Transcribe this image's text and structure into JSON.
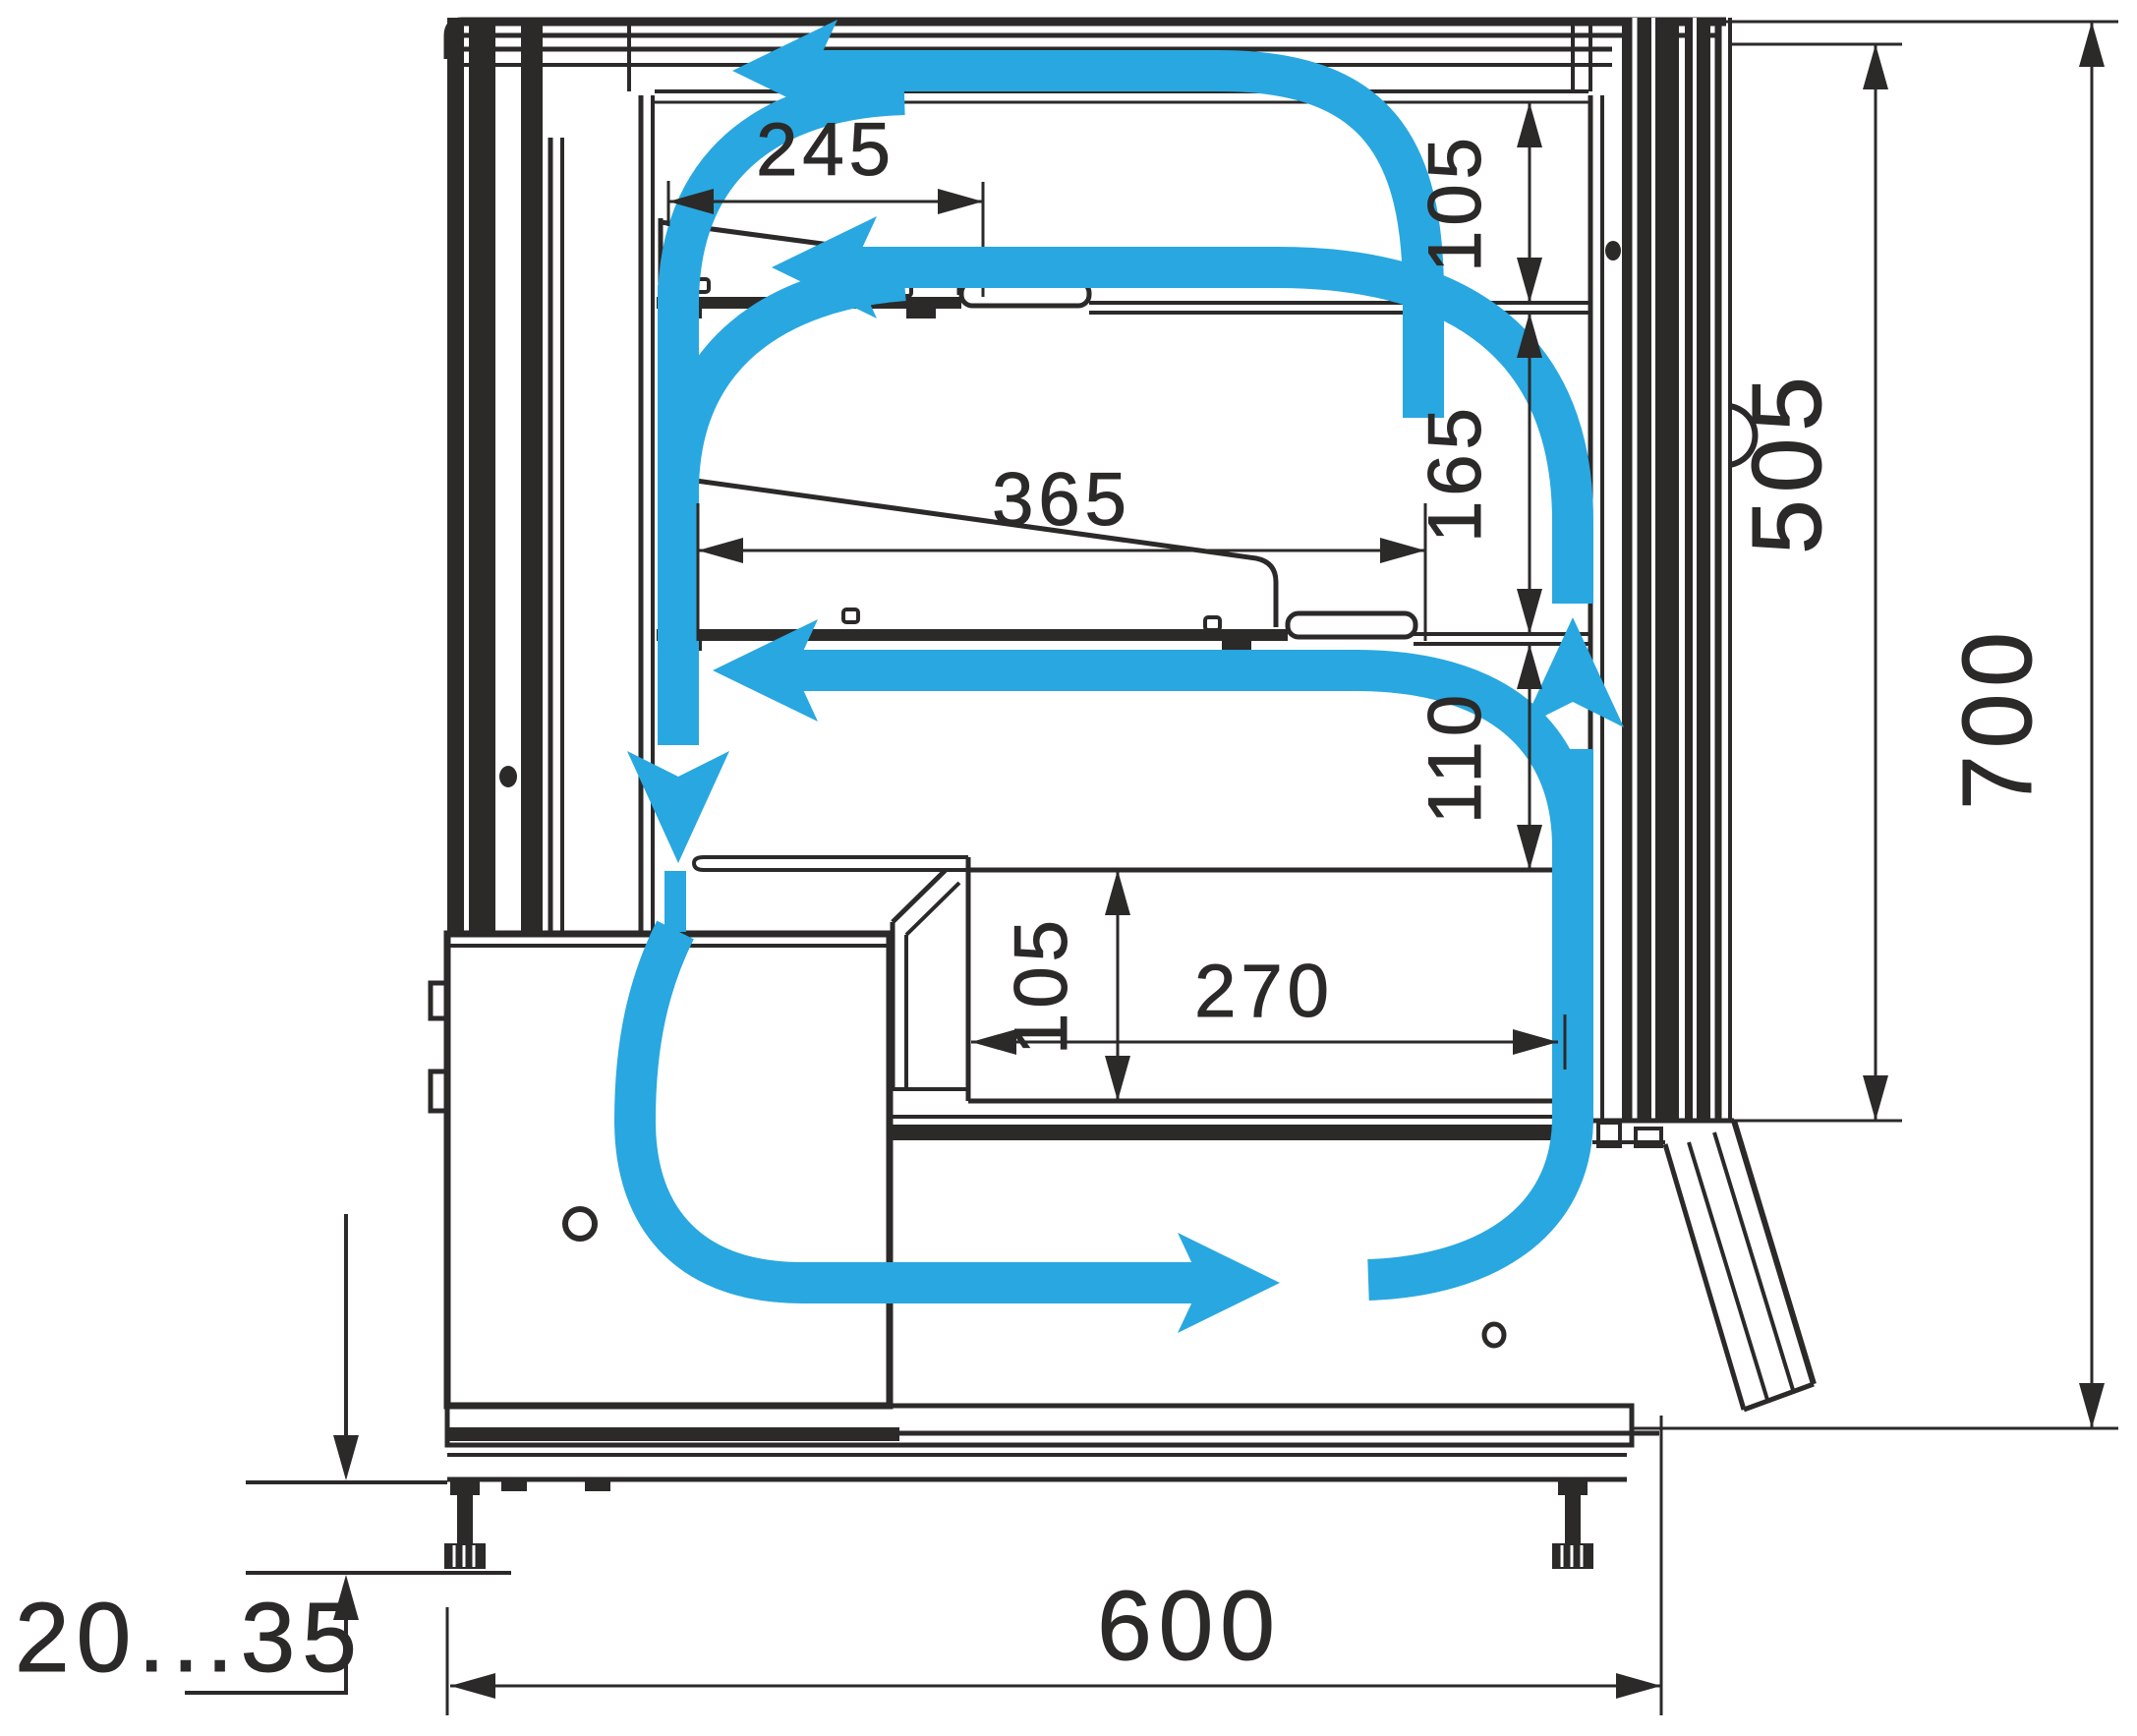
{
  "diagram": {
    "type": "technical-section-drawing",
    "subject": "Refrigerated confectionery display case cross-section with air circulation scheme",
    "units": "mm",
    "colors": {
      "line": "#2b2a29",
      "airflow": "#29a7e0",
      "background": "#ffffff"
    },
    "dimensions": {
      "top_shelf_depth": "245",
      "top_air_gap": "105",
      "middle_shelf_depth": "365",
      "middle_air_gap": "165",
      "lower_air_gap": "110",
      "well_depth": "105",
      "well_length": "270",
      "display_opening_height": "505",
      "overall_height": "700",
      "overall_depth": "600",
      "leg_adjustment_range": "20...35"
    },
    "airflow_arrows": [
      {
        "name": "top-canopy-flow",
        "direction": "left"
      },
      {
        "name": "upper-shelf-flow",
        "direction": "left"
      },
      {
        "name": "lower-shelf-flow",
        "direction": "left"
      },
      {
        "name": "back-duct-downflow",
        "direction": "down"
      },
      {
        "name": "base-duct-flow",
        "direction": "right"
      },
      {
        "name": "front-glass-upflow",
        "direction": "up"
      }
    ]
  }
}
